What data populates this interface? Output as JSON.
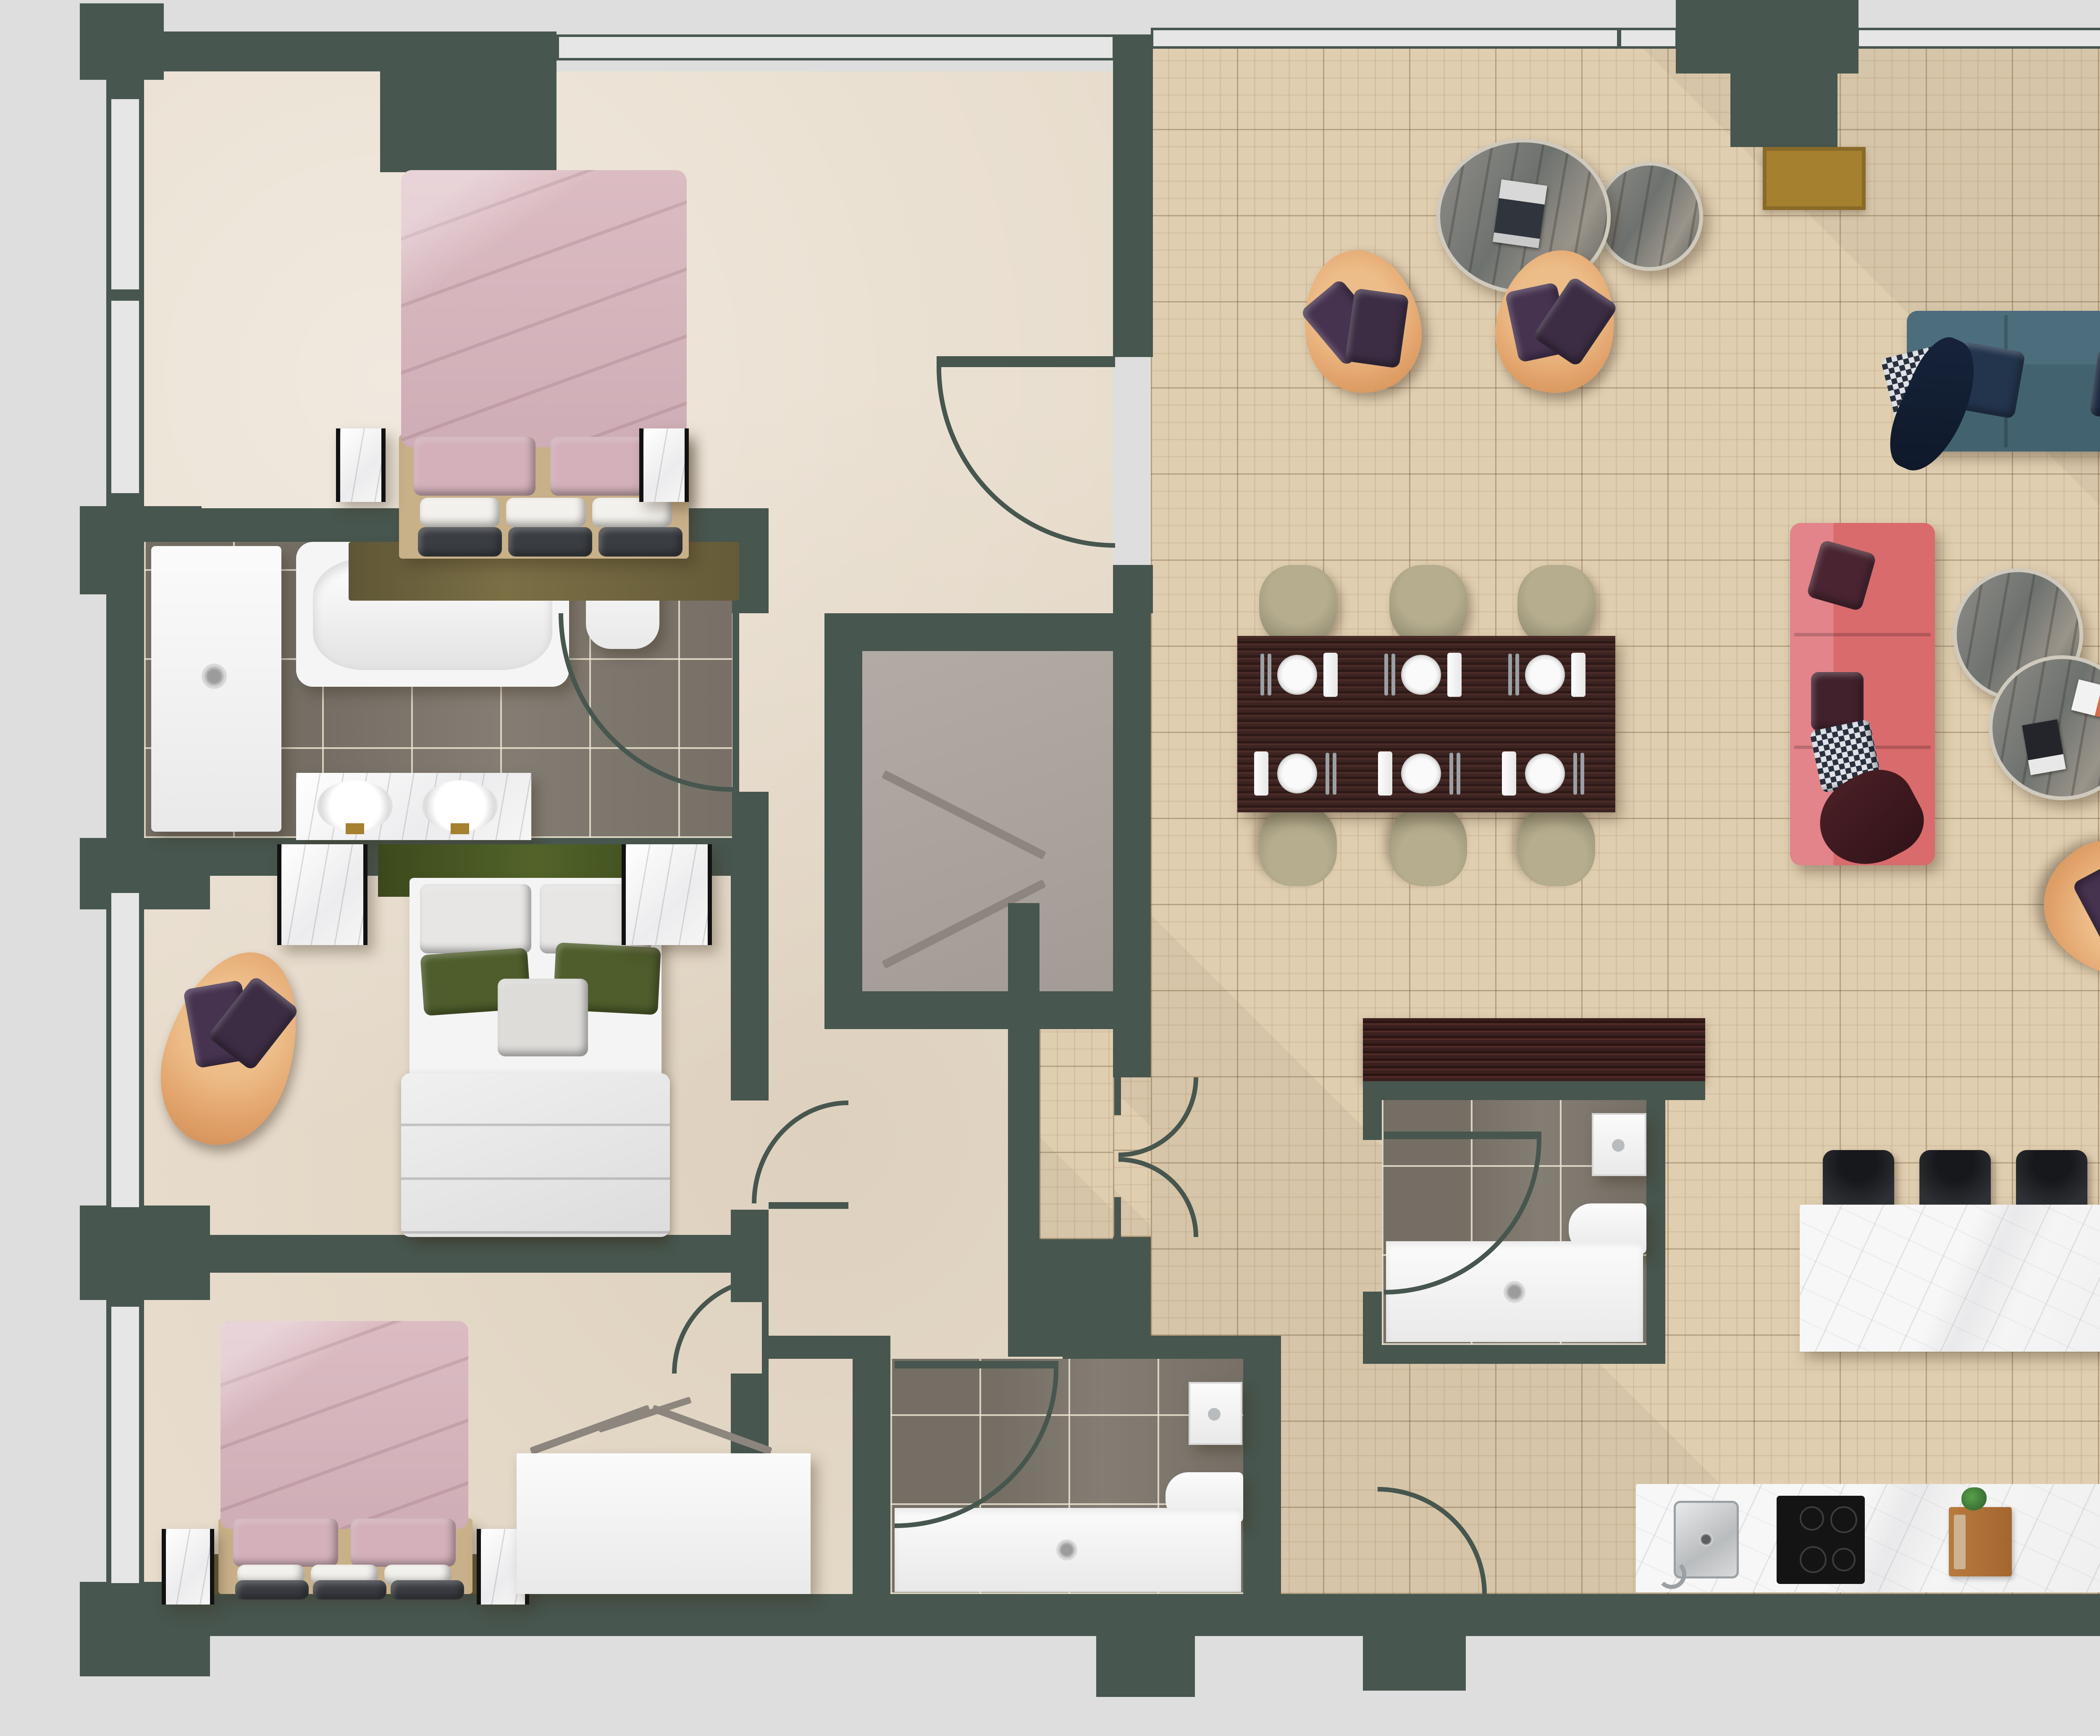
{
  "title": "Apartment floor plan — top-down architectural rendering",
  "plan_type": "floor-plan",
  "visible_text": [],
  "colors": {
    "wall": "#47564e",
    "canvas": "#dedede",
    "window_glass": "#e6e6e6",
    "floor_beige": "#e8ddcd",
    "floor_parquet": "#e0ceb0",
    "floor_tile_gray": "#7d766c",
    "floor_closet_gray": "#aba49d",
    "marble_white": "#f4f4f4",
    "dining_table_darkwood": "#3c2422",
    "dining_chair_olive": "#9a947a",
    "sofa_red": "#d96b6d",
    "sofa_teal": "#42626f",
    "armchair_orange": "#e3a56d",
    "pillow_navy": "#23344d",
    "pillow_maroon": "#4a2531",
    "pillow_purple": "#463350",
    "entry_mat_gold": "#a5812f",
    "sideboard_gold": "#9c7b33",
    "rug_olive": "#6f6540",
    "headboard_green": "#46541f",
    "bedding_pink": "#d6b3bb",
    "duvet_white": "#ededed",
    "bar_stool_black": "#27292d",
    "cooktop_black": "#151515",
    "plant_green": "#3e7c39",
    "console_dark_brown": "#3a201e",
    "stainless_steel": "#c4c6c8"
  },
  "rooms": [
    {
      "id": "bedroom-1",
      "floor": "beige plaster",
      "furniture": [
        "double bed with pink duvet",
        "two marble nightstands",
        "olive rug",
        "wall closet with door"
      ]
    },
    {
      "id": "bathroom-main",
      "floor": "gray tile",
      "furniture": [
        "walk-in shower tray",
        "bathtub",
        "toilet",
        "double vanity with two sinks"
      ]
    },
    {
      "id": "bedroom-2",
      "floor": "beige plaster",
      "furniture": [
        "bed with green headboard and white duvet",
        "two marble nightstands",
        "orange armchair with purple pillows"
      ]
    },
    {
      "id": "bedroom-3",
      "floor": "beige plaster",
      "furniture": [
        "double bed with pink duvet",
        "two marble nightstands",
        "olive rug",
        "white wardrobe with open-door marks"
      ]
    },
    {
      "id": "walk-in-closet",
      "floor": "gray",
      "furniture": [
        "shelving chevron marks"
      ]
    },
    {
      "id": "shower-room-left",
      "floor": "gray tile",
      "furniture": [
        "washbasin",
        "toilet",
        "shower tray"
      ]
    },
    {
      "id": "shower-room-center",
      "floor": "gray tile",
      "furniture": [
        "washbasin",
        "toilet",
        "shower tray",
        "dark brown console outside"
      ]
    },
    {
      "id": "living-dining-area",
      "floor": "parquet basket-weave",
      "furniture": [
        "two round marble coffee tables with magazine",
        "two orange lounge armchairs",
        "teal three-seat sofa",
        "red three-seat sofa",
        "two round marble side tables with magazines",
        "orange armchair",
        "gold sideboard with TV",
        "potted plant",
        "white wall console",
        "dining table with six place settings",
        "six olive dining chairs",
        "entry mat"
      ]
    },
    {
      "id": "kitchen",
      "floor": "parquet basket-weave",
      "furniture": [
        "marble island",
        "four black bar stools",
        "marble counter",
        "stainless sink",
        "black cooktop",
        "cutting board with knife",
        "herb plant",
        "white fridge cabinet"
      ]
    }
  ],
  "counts": {
    "bedrooms": 3,
    "bathrooms": 3,
    "dining_chairs": 6,
    "place_settings": 6,
    "bar_stools": 4,
    "sofas": 2,
    "armchairs": 4,
    "round_tables": 4,
    "doors_with_swing_arcs": 9,
    "windows": 10
  }
}
